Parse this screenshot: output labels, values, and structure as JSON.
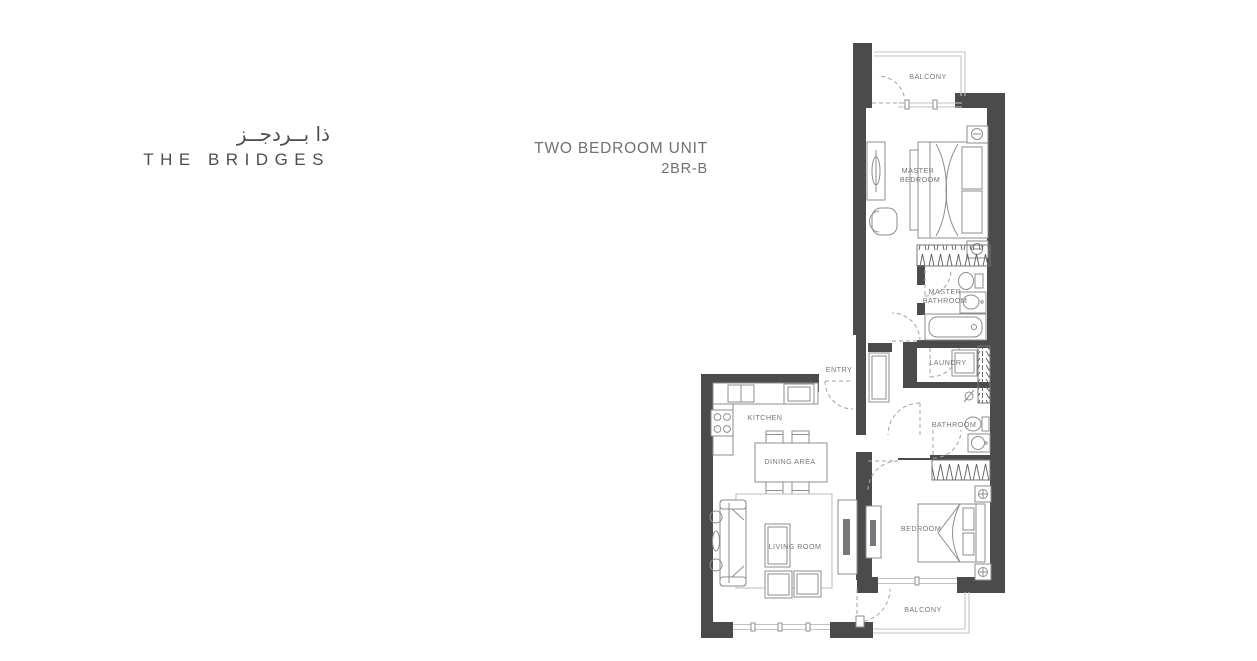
{
  "brand": {
    "arabic": "ذا بــردجــز",
    "english": "THE BRIDGES"
  },
  "unit": {
    "type": "TWO BEDROOM UNIT",
    "code": "2BR-B"
  },
  "rooms": {
    "balcony_top": "BALCONY",
    "master_bedroom": {
      "line1": "MASTER",
      "line2": "BEDROOM"
    },
    "master_bathroom": {
      "line1": "MASTER",
      "line2": "BATHROOM"
    },
    "laundry": "LAUNDRY",
    "entry": "ENTRY",
    "bathroom": "BATHROOM",
    "kitchen": "KITCHEN",
    "dining": "DINING AREA",
    "living": "LIVING ROOM",
    "bedroom": "BEDROOM",
    "balcony_bottom": "BALCONY"
  },
  "colors": {
    "wall": "#4b4b4d",
    "line": "#8e8e90",
    "light": "#c3c3c5",
    "label": "#77777b",
    "door": "#a3a3a5",
    "title": "#707073",
    "logo": "#4e4e50"
  }
}
